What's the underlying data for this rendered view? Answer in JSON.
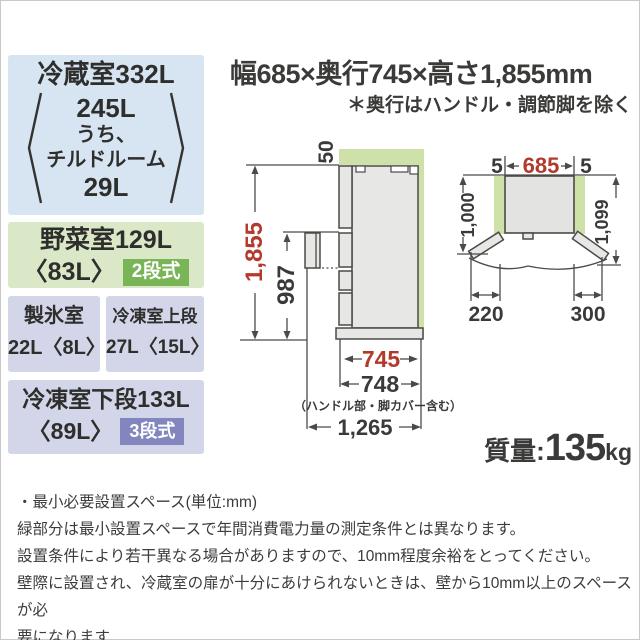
{
  "colors": {
    "accent_red": "#b23a2c",
    "green_zone": "#cde1a9",
    "box_blue": "#d7e4f1",
    "box_green": "#dae8c7",
    "box_lavender": "#d3d5e8",
    "badge_green": "#79b457",
    "badge_purple": "#8286bf",
    "diagram_fill": "#e7e7e5",
    "diagram_stroke": "#4a4a48",
    "text_dark": "#3a3a38"
  },
  "header": {
    "title": "幅685×奥行745×高さ1,855mm",
    "note": "＊奥行はハンドル・調節脚を除く"
  },
  "spec_boxes": {
    "fridge": {
      "title": "冷蔵室332L",
      "bracket": [
        "245L",
        "うち、",
        "チルドルーム",
        "29L"
      ]
    },
    "vegetable": {
      "title": "野菜室129L",
      "sub": "〈83L〉",
      "badge": "2段式"
    },
    "ice": {
      "title": "製氷室",
      "sub": "22L〈8L〉"
    },
    "freezer_upper": {
      "title": "冷凍室上段",
      "sub": "27L〈15L〉"
    },
    "freezer_lower": {
      "title": "冷凍室下段133L",
      "sub": "〈89L〉",
      "badge": "3段式"
    }
  },
  "side_view": {
    "clearance_top": "50",
    "height": "1,855",
    "handle_height": "987",
    "depth": "745",
    "depth_incl_handle": "748",
    "depth_note": "（ハンドル部・脚カバー含む）",
    "depth_door_open": "1,265"
  },
  "top_view": {
    "gap_left": "5",
    "width": "685",
    "gap_right": "5",
    "depth_left": "1,000",
    "depth_right": "1,099",
    "door_left": "220",
    "door_right": "300"
  },
  "weight": {
    "label": "質量:",
    "value": "135",
    "unit": "kg"
  },
  "footnotes": [
    "・最小必要設置スペース(単位:mm)",
    "緑部分は最小設置スペースで年間消費電力量の測定条件とは異なります。",
    "設置条件により若干異なる場合がありますので、10mm程度余裕をとってください。",
    "壁際に設置され、冷蔵室の扉が十分にあけられないときは、壁から10mm以上のスペースが必",
    "要になります"
  ]
}
